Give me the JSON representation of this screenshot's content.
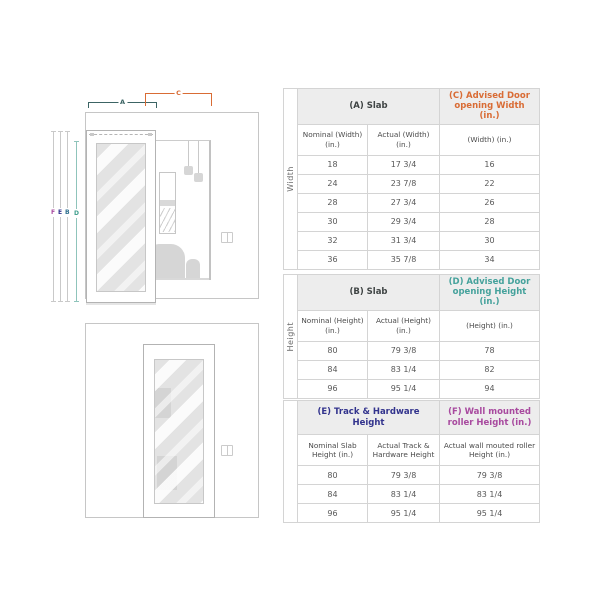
{
  "diagram": {
    "top": {
      "label_a": "A",
      "label_c": "C",
      "line_f": "F",
      "line_e": "E",
      "line_b": "B",
      "line_d": "D"
    }
  },
  "tables": {
    "width": {
      "side_label": "Width",
      "slab_header": "(A) Slab",
      "advised_header": "(C) Advised Door opening Width (in.)",
      "col1": "Nominal (Width) (in.)",
      "col2": "Actual (Width) (in.)",
      "col3": "(Width) (in.)",
      "rows": [
        [
          "18",
          "17 3/4",
          "16"
        ],
        [
          "24",
          "23 7/8",
          "22"
        ],
        [
          "28",
          "27 3/4",
          "26"
        ],
        [
          "30",
          "29 3/4",
          "28"
        ],
        [
          "32",
          "31 3/4",
          "30"
        ],
        [
          "36",
          "35 7/8",
          "34"
        ]
      ]
    },
    "height": {
      "side_label": "Height",
      "slab_header": "(B) Slab",
      "advised_header": "(D) Advised Door opening Height (in.)",
      "col1": "Nominal (Height) (in.)",
      "col2": "Actual (Height) (in.)",
      "col3": "(Height) (in.)",
      "rows": [
        [
          "80",
          "79 3/8",
          "78"
        ],
        [
          "84",
          "83 1/4",
          "82"
        ],
        [
          "96",
          "95 1/4",
          "94"
        ]
      ]
    },
    "track": {
      "side_label": "",
      "slab_header": "(E) Track & Hardware Height",
      "advised_header": "(F) Wall mounted roller Height (in.)",
      "col1": "Nominal Slab Height (in.)",
      "col2": "Actual Track & Hardware Height",
      "col3": "Actual wall mouted roller Height (in.)",
      "rows": [
        [
          "80",
          "79 3/8",
          "79 3/8"
        ],
        [
          "84",
          "83 1/4",
          "83 1/4"
        ],
        [
          "96",
          "95 1/4",
          "95 1/4"
        ]
      ]
    }
  },
  "colors": {
    "accent_a": "#3c6464",
    "accent_c_orange": "#d96c35",
    "accent_d_teal": "#45a29c",
    "accent_e_indigo": "#32338d",
    "accent_f_magenta": "#a84a9f",
    "accent_b_blue": "#2d6f8e",
    "table_border": "#d4d4d4",
    "header_bg": "#ededed",
    "line_gray": "#c9c9c9"
  }
}
